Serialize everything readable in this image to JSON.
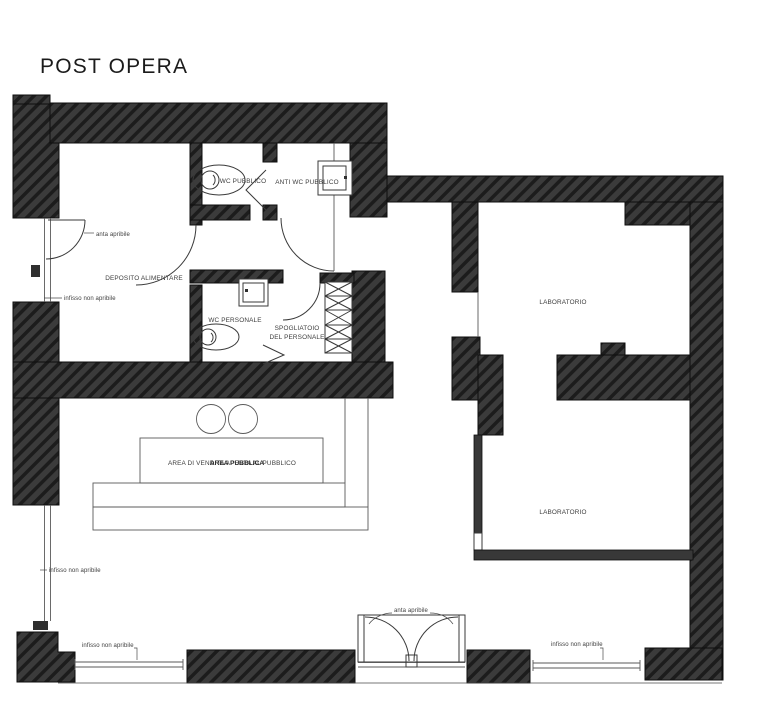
{
  "title": "POST OPERA",
  "colors": {
    "background": "#ffffff",
    "wall_fill": "#3b3b3b",
    "wall_hatch": "#1c1c1c",
    "line": "#3a3a3a",
    "label_text": "#3d3d3d"
  },
  "rooms": {
    "deposito": {
      "label": "DEPOSITO ALIMENTARE"
    },
    "wc_pubblico": {
      "label": "WC PUBBLICO"
    },
    "anti_wc": {
      "label": "ANTI WC PUBBLICO"
    },
    "wc_personale": {
      "label": "WC PERSONALE"
    },
    "spogliatoio": {
      "line1": "SPOGLIATOIO",
      "line2": "DEL PERSONALE"
    },
    "laboratorio_nord": {
      "label": "LABORATORIO"
    },
    "laboratorio_sud": {
      "label": "LABORATORIO"
    },
    "vendita": {
      "label": "AREA  DI VENDITA APERTA AL PUBBLICO",
      "overlay": "AREA PUBBLICA"
    }
  },
  "annotations": {
    "door_left": "anta apribile",
    "door_entrance": "anta apribile",
    "window_left_upper": "infisso non apribile",
    "window_left_lower": "infisso non apribile",
    "window_bottom_left": "infisso non apribile",
    "window_bottom_right": "infisso non apribile"
  }
}
